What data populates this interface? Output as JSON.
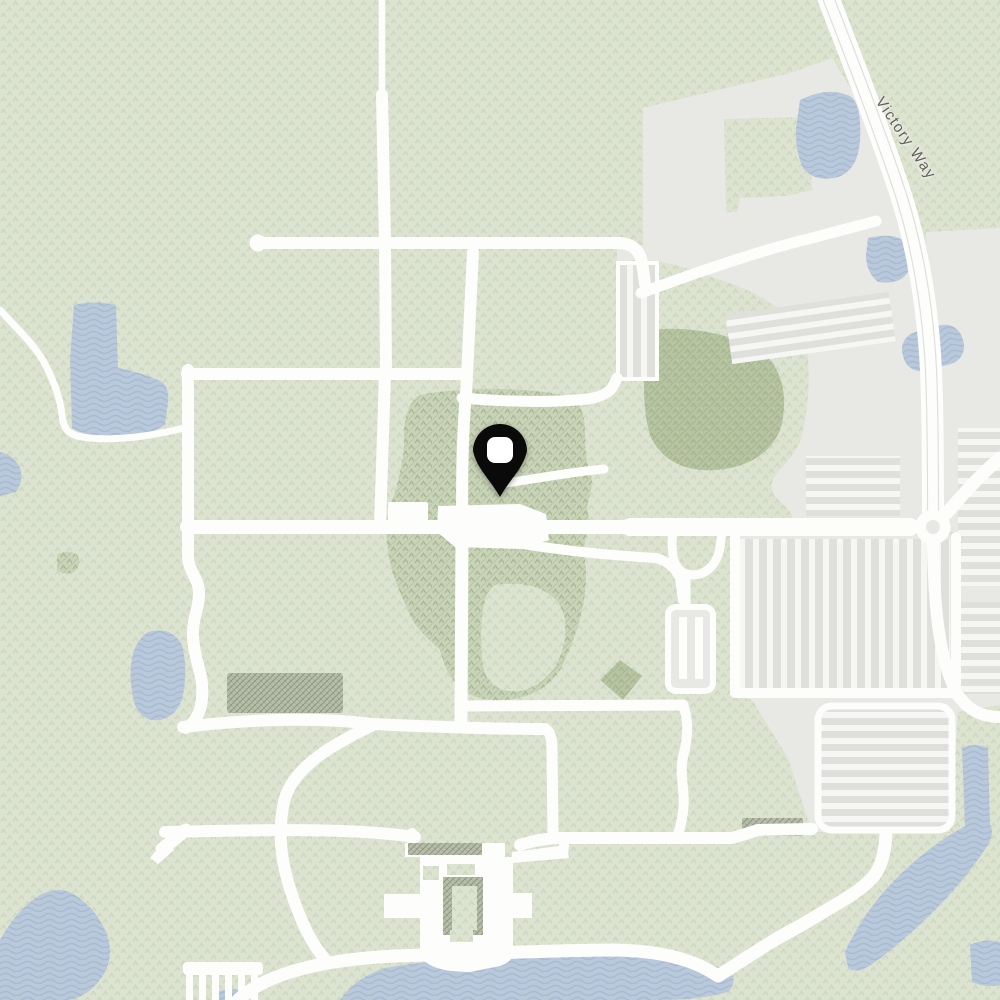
{
  "map": {
    "labels": [
      {
        "text": "Victory Way"
      }
    ],
    "marker": {
      "name": "location-pin"
    }
  },
  "theme": {
    "colors": {
      "grass": "#dce3d1",
      "grass_tex": "#bfcdaa",
      "woods": "#c8d3b8",
      "woods_dark": "#b6c4a2",
      "woods_tex": "#a2b18a",
      "woods_hatch": "#93a37f",
      "water": "#b9c9db",
      "water_wave": "#a4b9cf",
      "road": "#fdfdfb",
      "lot": "#e8e9e5",
      "lot_white": "#f6f6f4",
      "lot_stripe": "#dfe0dc",
      "structure": "#b7bfaa",
      "structure_hatch": "#707a62",
      "pin": "#0a0a0a",
      "pin_hole": "#ffffff",
      "label_text": "#5e5e58"
    }
  }
}
